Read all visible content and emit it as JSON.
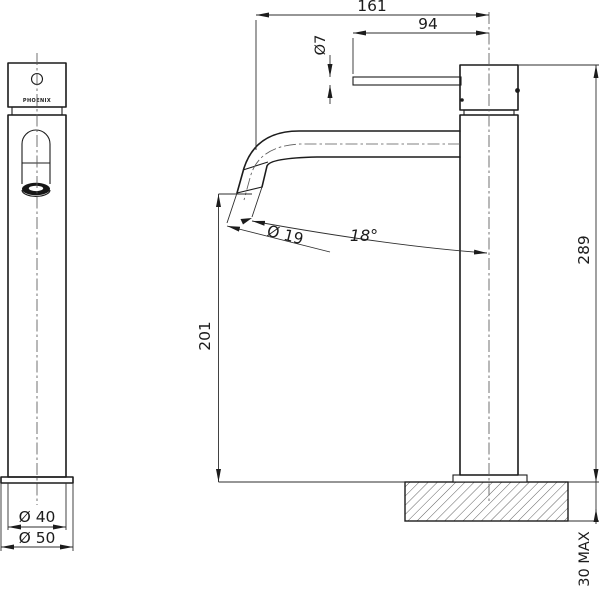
{
  "drawing": {
    "brand": "PHOENIX",
    "dimensions": {
      "reach_overall": "161",
      "lever_length": "94",
      "lever_diameter": "Ø7",
      "spout_diameter": "Ø 19",
      "spout_angle": "18°",
      "spout_height": "201",
      "overall_height": "289",
      "body_diameter": "Ø 40",
      "base_diameter": "Ø 50",
      "mounting_thickness": "30 MAX"
    }
  }
}
